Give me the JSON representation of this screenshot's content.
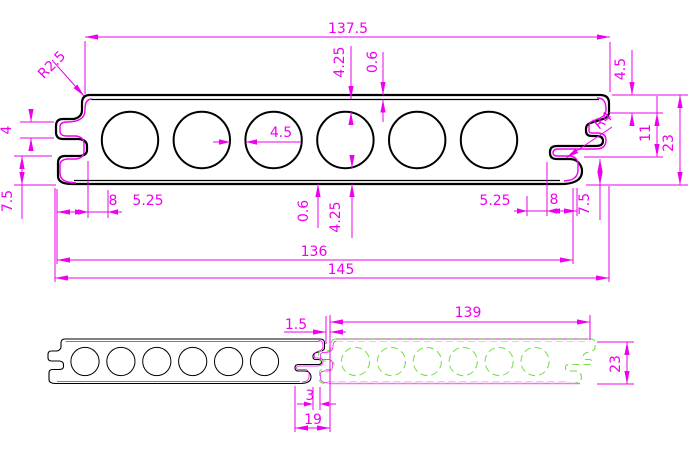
{
  "drawing": {
    "type": "CAD profile drawing of hollow composite decking board, cross-section and assembly views",
    "colors": {
      "dimension": "#EE00EE",
      "outline": "#000000",
      "mating_board": "#77DD44",
      "underlay_pink": "#F06EF0",
      "background": "#FFFFFF"
    },
    "main": {
      "width_top": "137.5",
      "wall_top": "4.25",
      "skin_top": "0.6",
      "corner_radius": "R2.5",
      "step_height": "4.5",
      "edge_height": "11",
      "total_height": "23",
      "lip_radius": "R4",
      "groove_height": "4",
      "web": "4.5",
      "lip_height_left": "7.5",
      "lip_height_right": "7.5",
      "seg8_left": "8",
      "seg525_left": "5.25",
      "seg525_right": "5.25",
      "seg8_right": "8",
      "skin_bottom": "0.6",
      "wall_bottom": "4.25",
      "width_inner": "136",
      "width_overall": "145"
    },
    "assembly": {
      "gap": "1.5",
      "cover_width": "139",
      "height": "23",
      "tongue_width": "3",
      "lap_width": "19"
    }
  }
}
